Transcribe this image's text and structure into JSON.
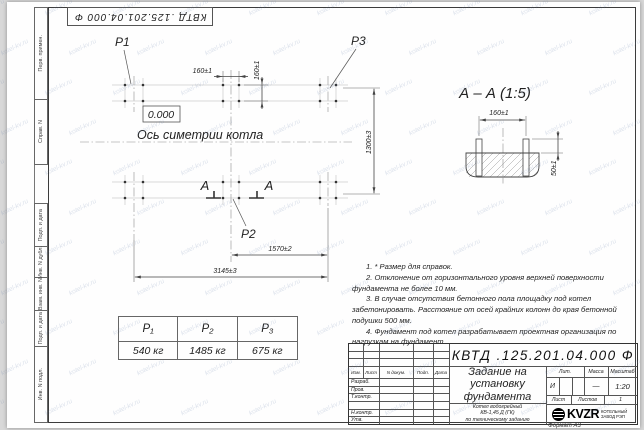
{
  "doc": {
    "number": "КВТД .125.201.04.000  Ф",
    "format": "Формат А3",
    "watermark": "kotel-kv.ru"
  },
  "frame": {
    "left_labels": [
      "Перв. примен.",
      "Справ. N",
      "Подп. и дата",
      "Инв. N дубл.",
      "Взам. инв. N",
      "Подп. и дата",
      "Инв. N подл."
    ]
  },
  "plan": {
    "p1": "P1",
    "p2": "P2",
    "p3": "P3",
    "elevation": "0.000",
    "axis_label": "Ось симетрии котла",
    "section_mark": "А",
    "dims": {
      "bolt_spacing_x": "160±1",
      "bolt_spacing_y": "160±1",
      "width": "1300±3",
      "half_length": "1570±2",
      "length": "3145±3"
    }
  },
  "section_view": {
    "title": "А – А (1:5)",
    "dims": {
      "bolt_spacing": "160±1",
      "protrusion": "50±1"
    }
  },
  "load_table": {
    "headers": [
      "P₁",
      "P₂",
      "P₃"
    ],
    "values": [
      "540 кг",
      "1485 кг",
      "675 кг"
    ]
  },
  "notes": {
    "items": [
      "1. * Размер для справок.",
      "2. Отклонение от горизонтального уровня верхней поверхности фундамента не более 10 мм.",
      "3. В случае отсутствия бетонного пола площадку под котел забетонировать. Расстояние от осей крайних колонн до края бетонной подушки 500 мм.",
      "4. Фундамент под котел разрабатывает проектная организация по нагрузкам на фундамент."
    ]
  },
  "title_block": {
    "designation": "КВТД .125.201.04.000  Ф",
    "name": "Задание на\nустановку\nфундамента",
    "product": "Котел водогрейный\nКВ-1,45 Д (ГК)\nпо техническому заданию",
    "header_cols": {
      "izm": "Изм.",
      "list": "Лист",
      "doc": "N докум.",
      "sign": "Подп.",
      "date": "Дата"
    },
    "roles": [
      "Разраб.",
      "Пров.",
      "Т.контр.",
      "",
      "Н.контр.",
      "Утв."
    ],
    "lit_label": "Лит.",
    "mass_label": "Масса",
    "scale_label": "Масштаб",
    "lit_value": "И",
    "mass_value": "—",
    "scale_value": "1:20",
    "sheet_label": "Лист",
    "sheets_label": "Листов",
    "sheets_value": "1",
    "logo_text": "KVZR",
    "logo_caption": "КОТЕЛЬНЫЙ\nЗАВОД РЭП"
  }
}
